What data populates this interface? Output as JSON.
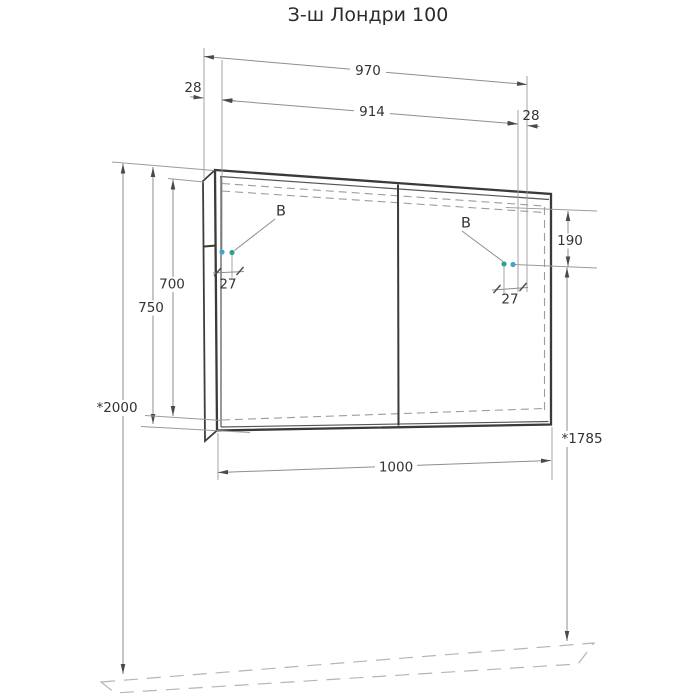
{
  "title": "З-ш Лондри 100",
  "drawing": {
    "dims": {
      "doors_width": "970",
      "gap_left": "28",
      "hinge_span": "914",
      "gap_right": "28",
      "hinge_top_offset": "190",
      "height_overall": "750",
      "height_front": "700",
      "hinge_inset_left": "27",
      "hinge_inset_right": "27",
      "overall_width": "1000",
      "mount_height_left": "*2000",
      "mount_height_right": "*1785"
    },
    "markers": {
      "hinge_left": "В",
      "hinge_right": "В"
    },
    "colors": {
      "dot_green": "#2EA489",
      "dot_blue": "#45A3C6",
      "outline": "#3a3a3a",
      "dimension": "#8e8e8e"
    }
  }
}
